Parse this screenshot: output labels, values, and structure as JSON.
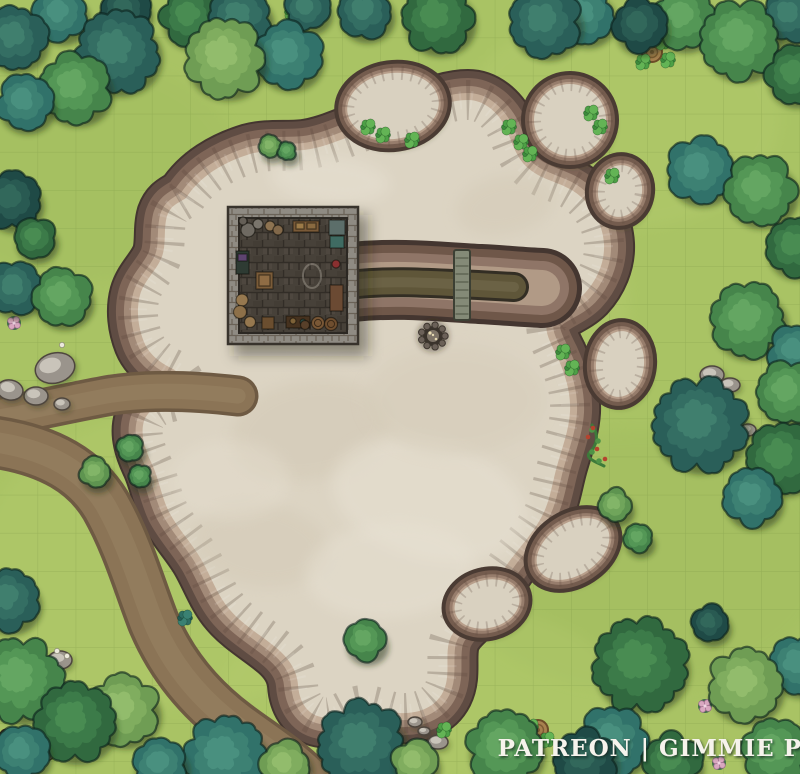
{
  "watermark": {
    "text": "PATREON | GIMMIE PIG"
  },
  "canvas": {
    "width": 800,
    "height": 774,
    "grid_size": 38.1,
    "grass": "#a9c364",
    "grid_line": "#73903f"
  },
  "palette": {
    "tree_outline": "rgba(10,32,26,0.6)",
    "tree_tones": {
      "teal": [
        "#2a5f59",
        "#346e63",
        "#41806f"
      ],
      "tealMid": [
        "#31726a",
        "#3d8173",
        "#4a9080"
      ],
      "tealDark": [
        "#1f4a46",
        "#295a52",
        "#33695c"
      ],
      "greenDark": [
        "#31693f",
        "#3c7b49",
        "#4a8d53"
      ],
      "greenMid": [
        "#46854b",
        "#549756",
        "#65a763"
      ],
      "greenLight": [
        "#5e9450",
        "#70a55b",
        "#83b569"
      ],
      "sage": [
        "#6f9d54",
        "#80ad5f",
        "#92bd6d"
      ],
      "bush": [
        "#3c8a3c",
        "#4da046",
        "#63b455"
      ],
      "bushTeal": [
        "#235a54",
        "#2e6e63",
        "#3a8173"
      ]
    },
    "road": {
      "edge": "#6e5a43",
      "base": "#8b7456",
      "highlight": "#9a8463"
    },
    "quarry": {
      "floor": "#dcd4c3",
      "rim": [
        "#443630",
        "#5f4c43",
        "#7e6557",
        "#a28a78",
        "#c3ad98"
      ],
      "shadow": "rgba(55,65,30,0.45)"
    },
    "island_rim": [
      "#4a3b33",
      "#745c4e",
      "#977d6c",
      "#b89f8b"
    ],
    "island_floor": "#d9d1c0",
    "trench": {
      "outline": "#332e24",
      "water": "#5f5639",
      "center": "#6b6245"
    },
    "bridge": {
      "deck": "#848a77",
      "outline": "#3c4034",
      "plank": "#5c6150"
    },
    "building": {
      "wall_outline": "#38332c",
      "floor_edge": "#2c2823",
      "chalk": "#d8d2c2"
    },
    "boulder": {
      "base": "#9a948c",
      "light": "#c9c4ba",
      "outline": "#4e463e"
    },
    "campfire": {
      "stone": "#6b6158",
      "pit": "#3a332b",
      "ash": "#7e7467",
      "ember": "#e5d9b0"
    },
    "log": {
      "body": "#8a603e",
      "stripe": "#6d4a2c",
      "outline": "#3f2d1c"
    },
    "stump": {
      "top": "#a8814f",
      "ring": "#7d5a33",
      "outline": "#6d4c28"
    },
    "vine": {
      "stem": "#3d7a3a",
      "leaf": "#4f9346",
      "berry": "#b5432e"
    },
    "flower": {
      "pink": "#d9a8c0",
      "pink_edge": "#a06f8e",
      "pink_center": "#f0d3e2",
      "white": "#ece9dc",
      "leafpad": "#2f5f45"
    }
  },
  "map": {
    "grass_patches": [
      [
        390,
        300,
        240,
        170,
        "#b9cf72",
        0.3
      ],
      [
        180,
        560,
        200,
        150,
        "#b9cf72",
        0.25
      ],
      [
        620,
        120,
        160,
        110,
        "#b9cf72",
        0.28
      ],
      [
        640,
        560,
        190,
        130,
        "#9cb85c",
        0.3
      ],
      [
        90,
        170,
        150,
        110,
        "#9cb85c",
        0.25
      ],
      [
        420,
        690,
        200,
        90,
        "#b9cf72",
        0.25
      ]
    ],
    "roads": [
      {
        "d": "M -6,418 C 40,410 72,402 112,395 C 152,389 196,391 238,396",
        "w": 34
      },
      {
        "d": "M -6,442 C 50,450 86,472 106,506 C 128,545 139,585 153,621 C 169,660 196,696 236,726 C 263,746 286,760 306,780",
        "w": 46
      }
    ],
    "quarry": {
      "d": "M 186,198 C 200,176 224,162 250,154 C 268,149 286,152 304,150 C 322,148 340,140 356,134 C 378,126 400,120 420,112 C 436,106 452,100 468,100 C 484,100 498,112 506,128 C 512,142 516,158 528,168 C 544,182 564,182 580,196 C 594,208 603,226 604,244 C 605,262 597,280 585,293 C 574,304 558,308 549,318 C 542,328 550,342 557,356 C 565,374 571,392 570,412 C 569,430 562,448 557,466 C 552,484 550,502 541,518 C 531,536 517,550 506,566 C 495,582 487,598 475,610 C 465,620 453,628 449,642 C 445,658 451,676 443,692 C 435,708 417,714 400,713 C 385,712 372,702 357,706 C 344,709 335,720 321,717 C 306,714 299,700 298,685 C 297,669 287,656 274,646 C 259,634 242,624 230,610 C 217,595 211,576 201,559 C 191,542 178,529 169,512 C 161,496 159,478 151,462 C 145,449 140,434 144,421 C 148,410 159,404 171,402 C 179,400 185,394 185,386 C 185,378 179,372 171,368 C 159,362 149,354 144,342 C 138,327 136,310 140,295 C 144,281 155,272 161,259 C 167,246 163,230 167,216 C 171,205 177,204 186,198 Z",
      "blotches": [
        [
          310,
          430,
          80,
          50,
          -10,
          "#cfc5b0",
          0.4
        ],
        [
          430,
          500,
          100,
          60,
          15,
          "#e8e2d4",
          0.5
        ],
        [
          260,
          545,
          70,
          42,
          8,
          "#cfc5b0",
          0.35
        ],
        [
          390,
          570,
          85,
          48,
          -5,
          "#e8e2d4",
          0.45
        ],
        [
          505,
          205,
          50,
          30,
          -12,
          "#cfc5b0",
          0.35
        ],
        [
          330,
          180,
          60,
          24,
          5,
          "#e8e2d4",
          0.5
        ],
        [
          455,
          400,
          90,
          55,
          0,
          "#d5ccb9",
          0.5
        ],
        [
          300,
          300,
          70,
          45,
          20,
          "#e6dfd0",
          0.4
        ],
        [
          230,
          480,
          60,
          40,
          0,
          "#e6dfd0",
          0.4
        ]
      ]
    },
    "trench": {
      "arm_d": "M 352,282 C 400,277 440,282 480,284 C 502,285 520,287 542,288",
      "trench_d": "M 358,284 C 400,280 440,284 478,285 L 514,287"
    },
    "bridge": {
      "x": 454,
      "y": 250,
      "w": 16,
      "h": 70
    },
    "campfire": {
      "cx": 433,
      "cy": 336,
      "r": 12
    },
    "building": {
      "x": 228,
      "y": 207,
      "w": 130,
      "h": 137,
      "wall": 11,
      "chalk": [
        312,
        276
      ],
      "props": [
        {
          "t": "c",
          "x": 248,
          "y": 230,
          "r": 7,
          "f": "#6f6a62"
        },
        {
          "t": "c",
          "x": 258,
          "y": 224,
          "r": 5,
          "f": "#7a756c"
        },
        {
          "t": "c",
          "x": 243,
          "y": 221,
          "r": 4,
          "f": "#655f57"
        },
        {
          "t": "c",
          "x": 270,
          "y": 226,
          "r": 5,
          "f": "#8d7351"
        },
        {
          "t": "c",
          "x": 278,
          "y": 230,
          "r": 5,
          "f": "#81684a"
        },
        {
          "t": "r",
          "x": 293,
          "y": 221,
          "w": 26,
          "h": 11,
          "f": "#7a5a38"
        },
        {
          "t": "r",
          "x": 296,
          "y": 223,
          "w": 8,
          "h": 6,
          "f": "#9c7a48"
        },
        {
          "t": "r",
          "x": 307,
          "y": 223,
          "w": 9,
          "h": 6,
          "f": "#8a6a40"
        },
        {
          "t": "r",
          "x": 329,
          "y": 220,
          "w": 16,
          "h": 15,
          "f": "#5c6e6a"
        },
        {
          "t": "r",
          "x": 236,
          "y": 251,
          "w": 13,
          "h": 23,
          "f": "#2e3b33"
        },
        {
          "t": "r",
          "x": 238,
          "y": 254,
          "w": 9,
          "h": 7,
          "f": "#5d4470"
        },
        {
          "t": "r",
          "x": 256,
          "y": 272,
          "w": 17,
          "h": 17,
          "f": "#7b5c39"
        },
        {
          "t": "r",
          "x": 259,
          "y": 275,
          "w": 11,
          "h": 11,
          "f": "#8f6c44"
        },
        {
          "t": "c",
          "x": 242,
          "y": 300,
          "r": 6,
          "f": "#96784f"
        },
        {
          "t": "c",
          "x": 240,
          "y": 312,
          "r": 6.5,
          "f": "#8d7049"
        },
        {
          "t": "c",
          "x": 250,
          "y": 322,
          "r": 5.5,
          "f": "#96784f"
        },
        {
          "t": "r",
          "x": 262,
          "y": 317,
          "w": 12,
          "h": 12,
          "f": "#6b4e2f"
        },
        {
          "t": "r",
          "x": 286,
          "y": 316,
          "w": 24,
          "h": 12,
          "f": "#46321f"
        },
        {
          "t": "c",
          "x": 293,
          "y": 321,
          "r": 3,
          "f": "#7e6238"
        },
        {
          "t": "c",
          "x": 303,
          "y": 322,
          "r": 3,
          "f": "#2f4f46"
        },
        {
          "t": "c",
          "x": 318,
          "y": 323,
          "r": 6.5,
          "f": "#7a5836",
          "ring": 1
        },
        {
          "t": "c",
          "x": 331,
          "y": 324,
          "r": 6.5,
          "f": "#6f4e2f",
          "ring": 1
        },
        {
          "t": "r",
          "x": 330,
          "y": 285,
          "w": 13,
          "h": 26,
          "f": "#6b4a33"
        },
        {
          "t": "r",
          "x": 330,
          "y": 236,
          "w": 14,
          "h": 12,
          "f": "#3f6b62"
        },
        {
          "t": "c",
          "x": 336,
          "y": 264,
          "r": 4,
          "f": "#8a3030"
        },
        {
          "t": "c",
          "x": 305,
          "y": 325,
          "r": 4.5,
          "f": "#58402a"
        }
      ]
    },
    "islands": [
      [
        393,
        106,
        46,
        33,
        -8
      ],
      [
        570,
        120,
        36,
        36,
        0
      ],
      [
        620,
        191,
        22,
        26,
        10
      ],
      [
        620,
        364,
        24,
        33,
        6
      ],
      [
        573,
        549,
        40,
        26,
        -33
      ],
      [
        487,
        604,
        33,
        24,
        -15
      ]
    ],
    "boulders": [
      [
        55,
        368,
        20,
        15,
        -15
      ],
      [
        36,
        396,
        12,
        9,
        0
      ],
      [
        62,
        404,
        8,
        6,
        0
      ],
      [
        10,
        390,
        13,
        10,
        10
      ],
      [
        60,
        660,
        12,
        9,
        0
      ],
      [
        415,
        722,
        7,
        5,
        0
      ],
      [
        424,
        731,
        6,
        4,
        0
      ],
      [
        438,
        742,
        10,
        7,
        0
      ],
      [
        712,
        375,
        12,
        9,
        0
      ],
      [
        730,
        385,
        10,
        7,
        0
      ],
      [
        748,
        430,
        8,
        6,
        0
      ],
      [
        305,
        8,
        12,
        9,
        0
      ],
      [
        350,
        726,
        8,
        6,
        0
      ]
    ],
    "log": {
      "cx": 26,
      "cy": 745,
      "len": 56,
      "w": 13,
      "angle": 24
    },
    "stumps": [
      [
        652,
        52
      ],
      [
        538,
        730
      ]
    ],
    "vine": {
      "d": "M 592,425 C 600,436 596,446 590,452 C 584,458 596,462 604,466",
      "leaves": [
        [
          592,
          430
        ],
        [
          598,
          441
        ],
        [
          592,
          452
        ],
        [
          599,
          461
        ]
      ],
      "berries": [
        [
          588,
          437
        ],
        [
          597,
          449
        ],
        [
          605,
          459
        ],
        [
          593,
          428
        ]
      ]
    },
    "flowers": {
      "pink": [
        [
          14,
          323
        ],
        [
          705,
          706
        ],
        [
          719,
          763
        ]
      ],
      "white": [
        [
          57,
          651
        ],
        [
          67,
          656
        ],
        [
          62,
          345
        ]
      ]
    },
    "tufts": [
      [
        368,
        127
      ],
      [
        383,
        135
      ],
      [
        412,
        140
      ],
      [
        509,
        127
      ],
      [
        521,
        142
      ],
      [
        530,
        154
      ],
      [
        612,
        176
      ],
      [
        591,
        113
      ],
      [
        600,
        127
      ],
      [
        563,
        352
      ],
      [
        572,
        368
      ],
      [
        292,
        12
      ],
      [
        318,
        6
      ],
      [
        444,
        730
      ],
      [
        531,
        727
      ],
      [
        547,
        740
      ],
      [
        185,
        618,
        "teal"
      ],
      [
        640,
        44
      ],
      [
        663,
        42
      ],
      [
        668,
        60
      ],
      [
        643,
        62
      ]
    ],
    "trees": [
      [
        15,
        38,
        30,
        "teal"
      ],
      [
        60,
        14,
        26,
        "tealMid"
      ],
      [
        125,
        10,
        24,
        "tealDark"
      ],
      [
        118,
        52,
        40,
        "teal"
      ],
      [
        25,
        102,
        27,
        "tealMid"
      ],
      [
        75,
        88,
        34,
        "greenMid"
      ],
      [
        190,
        17,
        28,
        "greenDark"
      ],
      [
        240,
        18,
        30,
        "teal"
      ],
      [
        307,
        8,
        22,
        "teal"
      ],
      [
        225,
        58,
        38,
        "sage"
      ],
      [
        288,
        55,
        32,
        "tealMid"
      ],
      [
        365,
        12,
        26,
        "teal"
      ],
      [
        438,
        18,
        34,
        "greenDark"
      ],
      [
        545,
        22,
        34,
        "teal"
      ],
      [
        585,
        15,
        28,
        "tealMid"
      ],
      [
        640,
        25,
        26,
        "tealDark"
      ],
      [
        683,
        18,
        30,
        "greenMid"
      ],
      [
        740,
        40,
        38,
        "greenMid"
      ],
      [
        790,
        15,
        26,
        "teal"
      ],
      [
        795,
        75,
        28,
        "greenDark"
      ],
      [
        12,
        200,
        28,
        "tealDark"
      ],
      [
        35,
        238,
        20,
        "greenDark"
      ],
      [
        15,
        288,
        26,
        "teal"
      ],
      [
        62,
        297,
        28,
        "greenMid"
      ],
      [
        700,
        170,
        32,
        "tealMid"
      ],
      [
        760,
        190,
        34,
        "greenMid"
      ],
      [
        795,
        247,
        28,
        "greenDark"
      ],
      [
        748,
        320,
        36,
        "greenMid"
      ],
      [
        795,
        352,
        26,
        "tealMid"
      ],
      [
        788,
        392,
        30,
        "greenMid"
      ],
      [
        700,
        425,
        45,
        "teal"
      ],
      [
        782,
        458,
        34,
        "greenDark"
      ],
      [
        752,
        497,
        28,
        "tealMid"
      ],
      [
        8,
        600,
        30,
        "teal"
      ],
      [
        20,
        680,
        40,
        "greenMid"
      ],
      [
        75,
        722,
        38,
        "greenDark"
      ],
      [
        22,
        752,
        26,
        "tealMid"
      ],
      [
        123,
        710,
        34,
        "sage"
      ],
      [
        160,
        765,
        26,
        "tealMid"
      ],
      [
        225,
        758,
        40,
        "tealMid"
      ],
      [
        285,
        765,
        24,
        "sage"
      ],
      [
        362,
        745,
        42,
        "teal"
      ],
      [
        415,
        762,
        22,
        "sage"
      ],
      [
        505,
        748,
        36,
        "greenMid"
      ],
      [
        585,
        760,
        30,
        "tealDark"
      ],
      [
        710,
        623,
        18,
        "tealDark"
      ],
      [
        640,
        665,
        45,
        "greenDark"
      ],
      [
        612,
        742,
        34,
        "tealMid"
      ],
      [
        672,
        762,
        28,
        "greenDark"
      ],
      [
        745,
        685,
        35,
        "sage"
      ],
      [
        798,
        665,
        28,
        "tealMid"
      ],
      [
        775,
        752,
        32,
        "greenMid"
      ],
      [
        130,
        448,
        13,
        "greenMid"
      ],
      [
        140,
        476,
        11,
        "greenMid"
      ],
      [
        95,
        472,
        15,
        "greenLight"
      ],
      [
        270,
        146,
        11,
        "greenLight"
      ],
      [
        287,
        151,
        9,
        "greenMid"
      ],
      [
        365,
        640,
        20,
        "greenMid"
      ],
      [
        615,
        505,
        16,
        "greenLight"
      ],
      [
        638,
        538,
        14,
        "greenMid"
      ]
    ]
  }
}
